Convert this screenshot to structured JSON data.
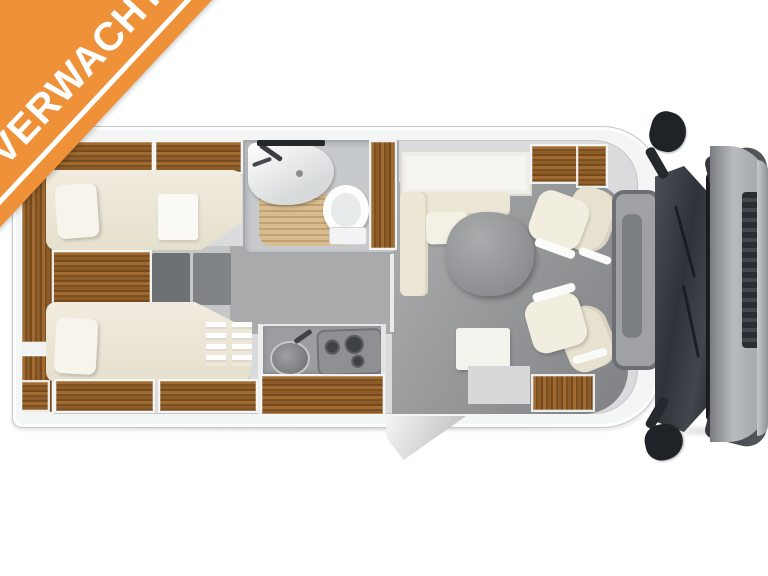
{
  "badge": {
    "text": "VERWACHT",
    "background": "#EF9138",
    "stripe_color": "#FFFFFF",
    "text_color": "#FFFFFF",
    "position": "top-left-diagonal"
  },
  "scene": {
    "type": "motorhome-floorplan-top-view",
    "background": "#FFFFFF",
    "cab_position": "right"
  },
  "palette": {
    "body_shell": "#F4F5F5",
    "wall_line": "#C7C9CB",
    "wood": "#8E5C29",
    "mattress": "#EDE8DA",
    "pillow": "#F7F4EC",
    "floor_light": "#C6C7C9",
    "floor_mid": "#A8AAAC",
    "floor_dark": "#87898C",
    "table": "#94969A",
    "shower_floor": "#D9BD92",
    "glass": "#2E3339",
    "hood": "#B9BCBE",
    "trim_dark": "#25282B"
  },
  "floorplan": {
    "rooms": [
      {
        "name": "rear-bedroom",
        "features": [
          "single-bed-top",
          "single-bed-bottom",
          "pillows",
          "wardrobe",
          "mid-steps",
          "overhead-lockers",
          "bed-ladder"
        ]
      },
      {
        "name": "bathroom",
        "features": [
          "washbasin",
          "mirror",
          "faucet",
          "toilet",
          "shower-slat-floor",
          "wood-column"
        ]
      },
      {
        "name": "kitchen",
        "features": [
          "round-sink",
          "gas-hob",
          "worktop",
          "wood-cabinet-front"
        ]
      },
      {
        "name": "dinette",
        "features": [
          "l-bench",
          "oval-table",
          "side-cabinet"
        ]
      },
      {
        "name": "cab",
        "features": [
          "driver-swivel-seat",
          "passenger-swivel-seat",
          "dashboard",
          "windshield",
          "wipers",
          "hood",
          "grille",
          "side-mirror-top",
          "side-mirror-bottom"
        ]
      },
      {
        "name": "entrance",
        "features": [
          "open-door",
          "wood-entry-step"
        ]
      }
    ]
  }
}
